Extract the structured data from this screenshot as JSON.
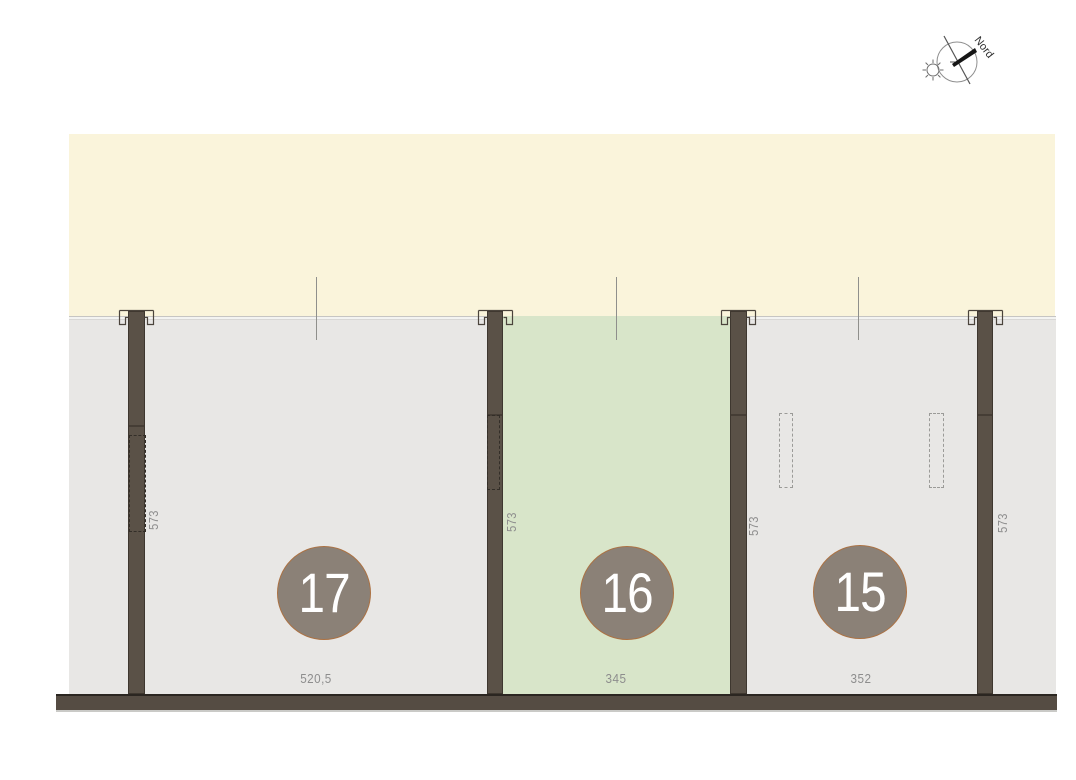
{
  "compass": {
    "label": "Nord"
  },
  "plots": [
    {
      "number": "17",
      "width_label": "520,5",
      "highlighted": false
    },
    {
      "number": "16",
      "width_label": "345",
      "highlighted": true
    },
    {
      "number": "15",
      "width_label": "352",
      "highlighted": false
    }
  ],
  "walls": [
    {
      "depth_label": "573"
    },
    {
      "depth_label": "573"
    },
    {
      "depth_label": "573"
    },
    {
      "depth_label": "573"
    }
  ],
  "colors": {
    "upper_area": "#faf4db",
    "plot_area": "#e8e7e5",
    "highlight_plot": "#d8e5c9",
    "wall": "#5a5147",
    "badge_fill": "#8b8177",
    "badge_border": "#ab7244",
    "dimension_text": "#8d8d8d"
  }
}
